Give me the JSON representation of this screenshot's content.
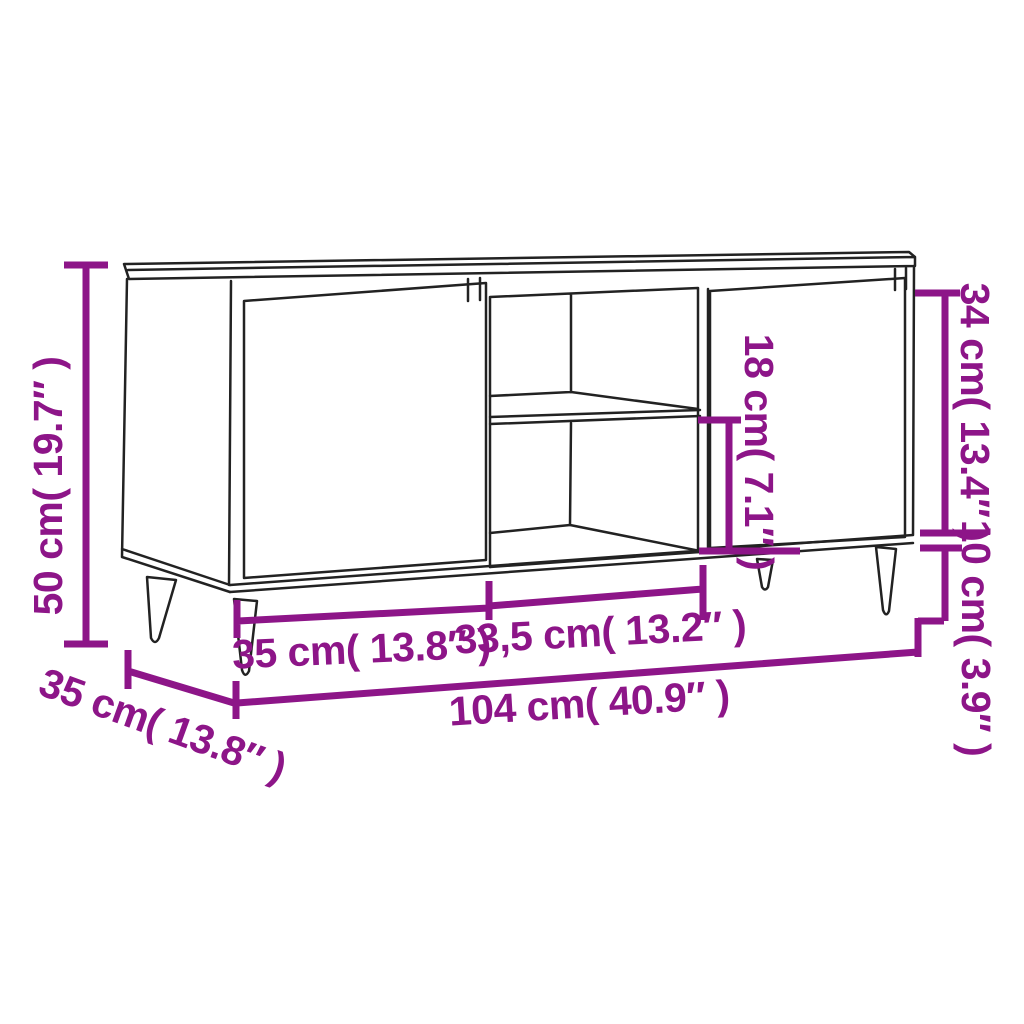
{
  "diagram": {
    "title": "TV cabinet dimension diagram",
    "accent_color": "#8D1588",
    "line_color": "#222222",
    "background_color": "#ffffff",
    "labels": {
      "height": "50 cm( 19.7″ )",
      "depth": "35 cm( 13.8″ )",
      "left_section_width": "35 cm( 13.8″ )",
      "middle_section_width": "33,5 cm( 13.2″ )",
      "total_width": "104 cm( 40.9″ )",
      "middle_compartment_height": "18 cm( 7.1″ )",
      "door_panel_height": "34 cm( 13.4″ )",
      "leg_height": "10 cm( 3.9″ )"
    }
  }
}
